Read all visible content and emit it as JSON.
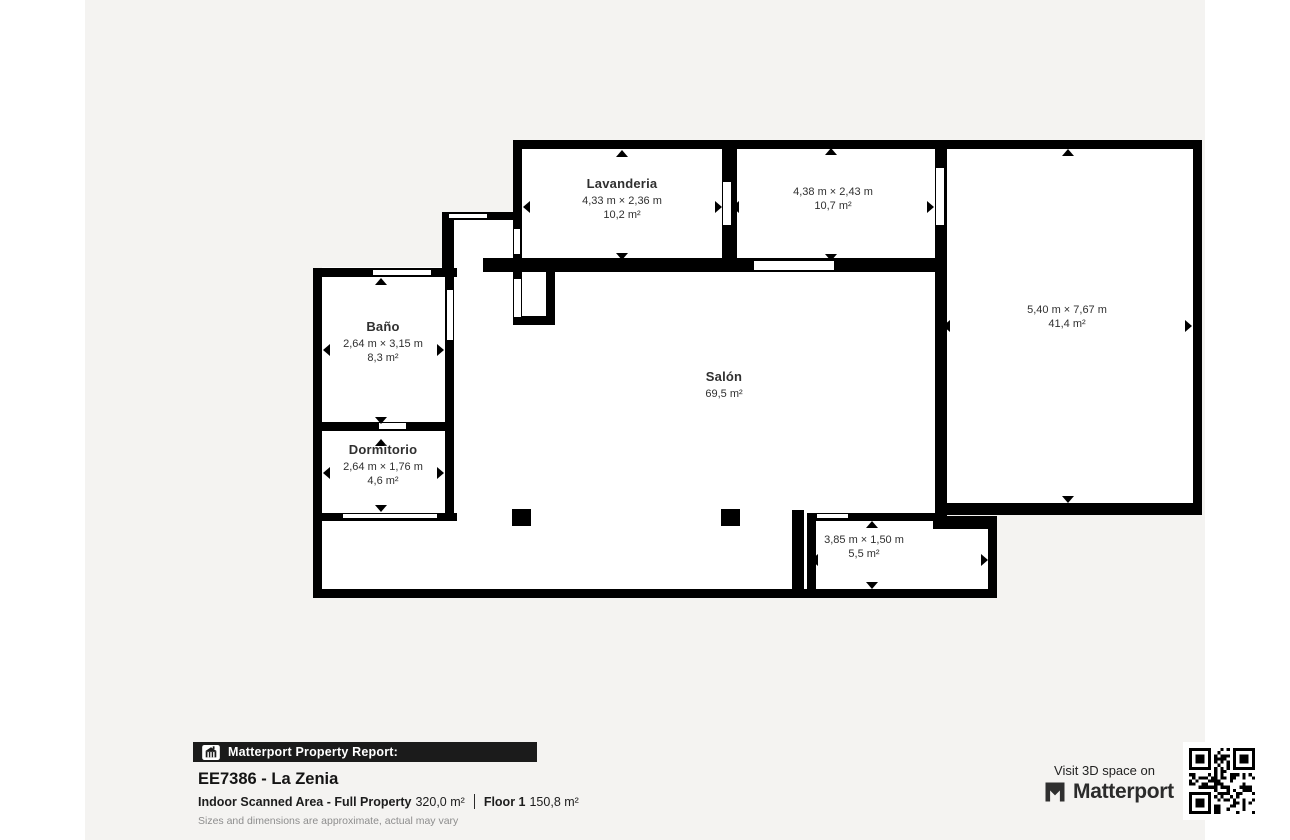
{
  "colors": {
    "canvas": "#f4f3f1",
    "wall": "#000000",
    "floor": "#ffffff",
    "text": "#303030",
    "footer_bar": "#1b1b1b",
    "muted": "#8d8d8d"
  },
  "floorplan": {
    "rooms": [
      {
        "name": "Lavanderia",
        "dims": "4,33 m × 2,36 m",
        "area": "10,2 m²",
        "cx": 537,
        "top": 176
      },
      {
        "name": "",
        "dims": "4,38 m × 2,43 m",
        "area": "10,7 m²",
        "cx": 748,
        "top": 186
      },
      {
        "name": "",
        "dims": "5,40 m × 7,67 m",
        "area": "41,4 m²",
        "cx": 982,
        "top": 304
      },
      {
        "name": "Baño",
        "dims": "2,64 m × 3,15 m",
        "area": "8,3 m²",
        "cx": 298,
        "top": 319
      },
      {
        "name": "Dormitorio",
        "dims": "2,64 m × 1,76 m",
        "area": "4,6 m²",
        "cx": 298,
        "top": 442
      },
      {
        "name": "Salón",
        "dims": "",
        "area": "69,5 m²",
        "cx": 639,
        "top": 369
      },
      {
        "name": "",
        "dims": "3,85 m × 1,50 m",
        "area": "5,5 m²",
        "cx": 779,
        "top": 534
      }
    ],
    "floors": [
      [
        437,
        149,
        200,
        109
      ],
      [
        652,
        149,
        198,
        109
      ],
      [
        862,
        149,
        246,
        354
      ],
      [
        366,
        220,
        62,
        47
      ],
      [
        237,
        267,
        614,
        322
      ],
      [
        723,
        517,
        180,
        72
      ]
    ],
    "walls": [
      [
        428,
        140,
        689,
        9
      ],
      [
        1108,
        140,
        9,
        375
      ],
      [
        850,
        503,
        267,
        12
      ],
      [
        850,
        140,
        12,
        381
      ],
      [
        428,
        140,
        9,
        118
      ],
      [
        637,
        149,
        15,
        109
      ],
      [
        398,
        258,
        464,
        14
      ],
      [
        357,
        212,
        80,
        8
      ],
      [
        357,
        212,
        12,
        65
      ],
      [
        428,
        258,
        9,
        67
      ],
      [
        461,
        272,
        9,
        53
      ],
      [
        428,
        316,
        42,
        9
      ],
      [
        228,
        268,
        144,
        9
      ],
      [
        228,
        268,
        9,
        330
      ],
      [
        360,
        277,
        9,
        244
      ],
      [
        228,
        422,
        141,
        9
      ],
      [
        228,
        513,
        144,
        8
      ],
      [
        228,
        589,
        491,
        9
      ],
      [
        707,
        510,
        12,
        88
      ],
      [
        722,
        513,
        9,
        85
      ],
      [
        722,
        513,
        133,
        8
      ],
      [
        848,
        516,
        64,
        13
      ],
      [
        903,
        516,
        9,
        82
      ],
      [
        717,
        589,
        195,
        9
      ]
    ],
    "windows": [
      [
        363,
        213,
        40,
        6
      ],
      [
        287,
        269,
        60,
        7
      ],
      [
        668,
        260,
        82,
        11
      ],
      [
        257,
        513,
        96,
        6
      ],
      [
        293,
        422,
        29,
        8
      ],
      [
        731,
        513,
        33,
        6
      ]
    ],
    "openings": [
      [
        851,
        168,
        8,
        57
      ],
      [
        638,
        182,
        8,
        43
      ],
      [
        429,
        229,
        6,
        25
      ],
      [
        429,
        279,
        7,
        38
      ],
      [
        362,
        290,
        6,
        50
      ]
    ],
    "pillars": [
      [
        427,
        509,
        19,
        17
      ],
      [
        636,
        509,
        19,
        17
      ]
    ],
    "arrows": [
      {
        "x": 537,
        "y": 153,
        "dir": "up"
      },
      {
        "x": 441,
        "y": 207,
        "dir": "left"
      },
      {
        "x": 633,
        "y": 207,
        "dir": "right"
      },
      {
        "x": 537,
        "y": 256,
        "dir": "down"
      },
      {
        "x": 746,
        "y": 151,
        "dir": "up"
      },
      {
        "x": 650,
        "y": 207,
        "dir": "left"
      },
      {
        "x": 845,
        "y": 207,
        "dir": "right"
      },
      {
        "x": 746,
        "y": 257,
        "dir": "down"
      },
      {
        "x": 983,
        "y": 152,
        "dir": "up"
      },
      {
        "x": 861,
        "y": 326,
        "dir": "left"
      },
      {
        "x": 1103,
        "y": 326,
        "dir": "right"
      },
      {
        "x": 983,
        "y": 499,
        "dir": "down"
      },
      {
        "x": 296,
        "y": 281,
        "dir": "up"
      },
      {
        "x": 241,
        "y": 350,
        "dir": "left"
      },
      {
        "x": 355,
        "y": 350,
        "dir": "right"
      },
      {
        "x": 296,
        "y": 420,
        "dir": "down"
      },
      {
        "x": 296,
        "y": 442,
        "dir": "up"
      },
      {
        "x": 241,
        "y": 473,
        "dir": "left"
      },
      {
        "x": 355,
        "y": 473,
        "dir": "right"
      },
      {
        "x": 296,
        "y": 508,
        "dir": "down"
      },
      {
        "x": 787,
        "y": 524,
        "dir": "up"
      },
      {
        "x": 729,
        "y": 560,
        "dir": "left"
      },
      {
        "x": 899,
        "y": 560,
        "dir": "right"
      },
      {
        "x": 787,
        "y": 585,
        "dir": "down"
      }
    ]
  },
  "footer": {
    "report_label": "Matterport Property Report:",
    "title": "EE7386 - La Zenia",
    "scan_label": "Indoor Scanned Area - Full Property",
    "scan_value": "320,0 m²",
    "floor_label": "Floor 1",
    "floor_value": "150,8 m²",
    "disclaimer": "Sizes and dimensions are approximate, actual may vary"
  },
  "cta": {
    "visit_text": "Visit 3D space on",
    "brand": "Matterport"
  }
}
